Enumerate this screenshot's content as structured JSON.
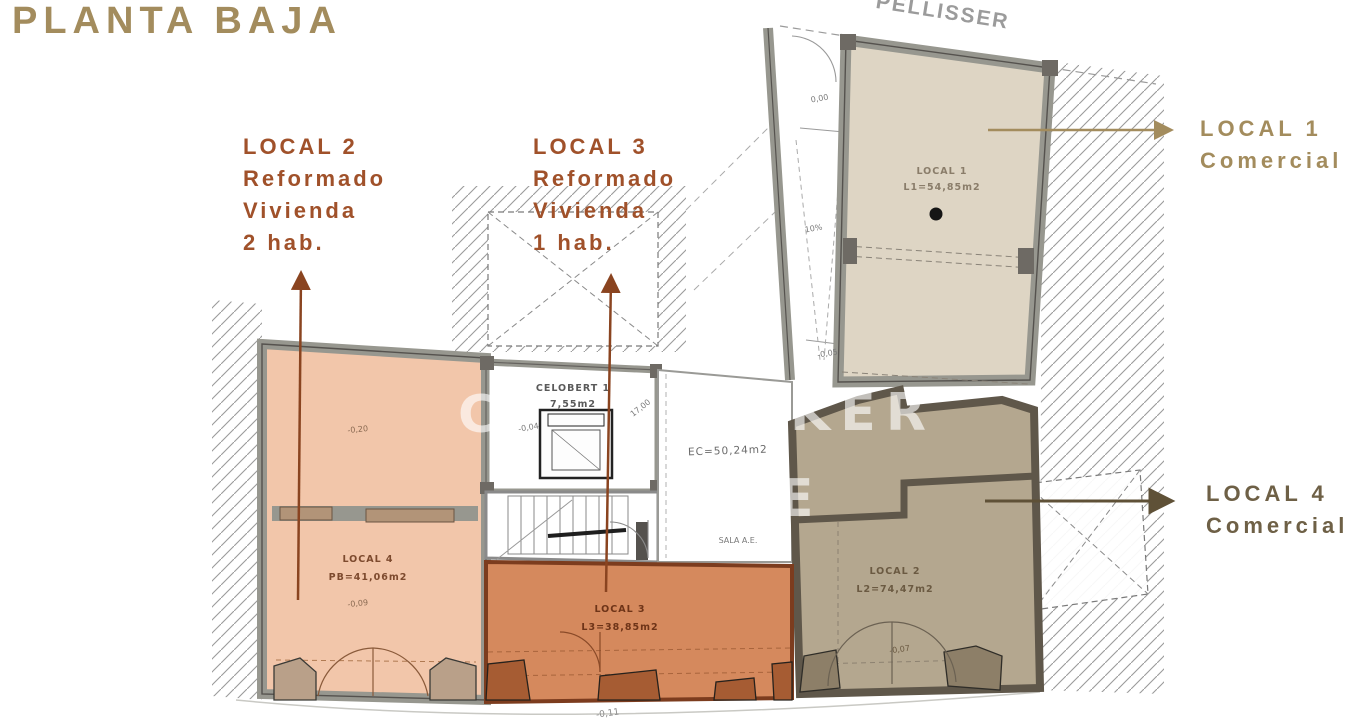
{
  "page": {
    "title": "PLANTA BAJA",
    "street_label": "PELLISSER"
  },
  "colors": {
    "title_tan": "#a38c5d",
    "callout_rust": "#a0512a",
    "callout_olive": "#6e6046",
    "arrow_rust": "#8a4420",
    "salmon_room_fill": "#f2c6aa",
    "orange_room_fill": "#d5895d",
    "orange_wall": "#7c3c1e",
    "beige_room_fill": "#ded5c4",
    "brown_room_fill": "#b4a78f",
    "brown_wall": "#5f574a",
    "wall_gray": "#97978f"
  },
  "callouts": {
    "local2": {
      "lines": [
        "LOCAL 2",
        "Reformado",
        "Vivienda",
        "2 hab."
      ]
    },
    "local3": {
      "lines": [
        "LOCAL 3",
        "Reformado",
        "Vivienda",
        "1 hab."
      ]
    },
    "local1": {
      "lines": [
        "LOCAL 1",
        "Comercial"
      ]
    },
    "local4": {
      "lines": [
        "LOCAL 4",
        "Comercial"
      ]
    }
  },
  "plan": {
    "rooms": {
      "local1": {
        "name": "LOCAL 1",
        "area": "L1=54,85m2"
      },
      "local2": {
        "name": "LOCAL 2",
        "area": "L2=74,47m2",
        "elevation": "-0,07"
      },
      "local3": {
        "name": "LOCAL 3",
        "area": "L3=38,85m2"
      },
      "local4": {
        "name": "LOCAL 4",
        "area": "PB=41,06m2",
        "elev_upper": "-0,20",
        "elev_lower": "-0,09"
      },
      "celobert": {
        "name": "CELOBERT 1",
        "area": "7,55m2"
      },
      "common": {
        "area": "EC=50,24m2",
        "sala": "SALA A.E."
      },
      "ramp": {
        "top": "0,00",
        "slope": "10%",
        "bottom": "-0,05"
      }
    },
    "marks": {
      "dim_corner": "17,00",
      "celobert_elev": "-0,04",
      "street_elev": "-0,11"
    },
    "watermark": {
      "frag1": "C",
      "frag2": "KER",
      "frag3": "E"
    }
  }
}
